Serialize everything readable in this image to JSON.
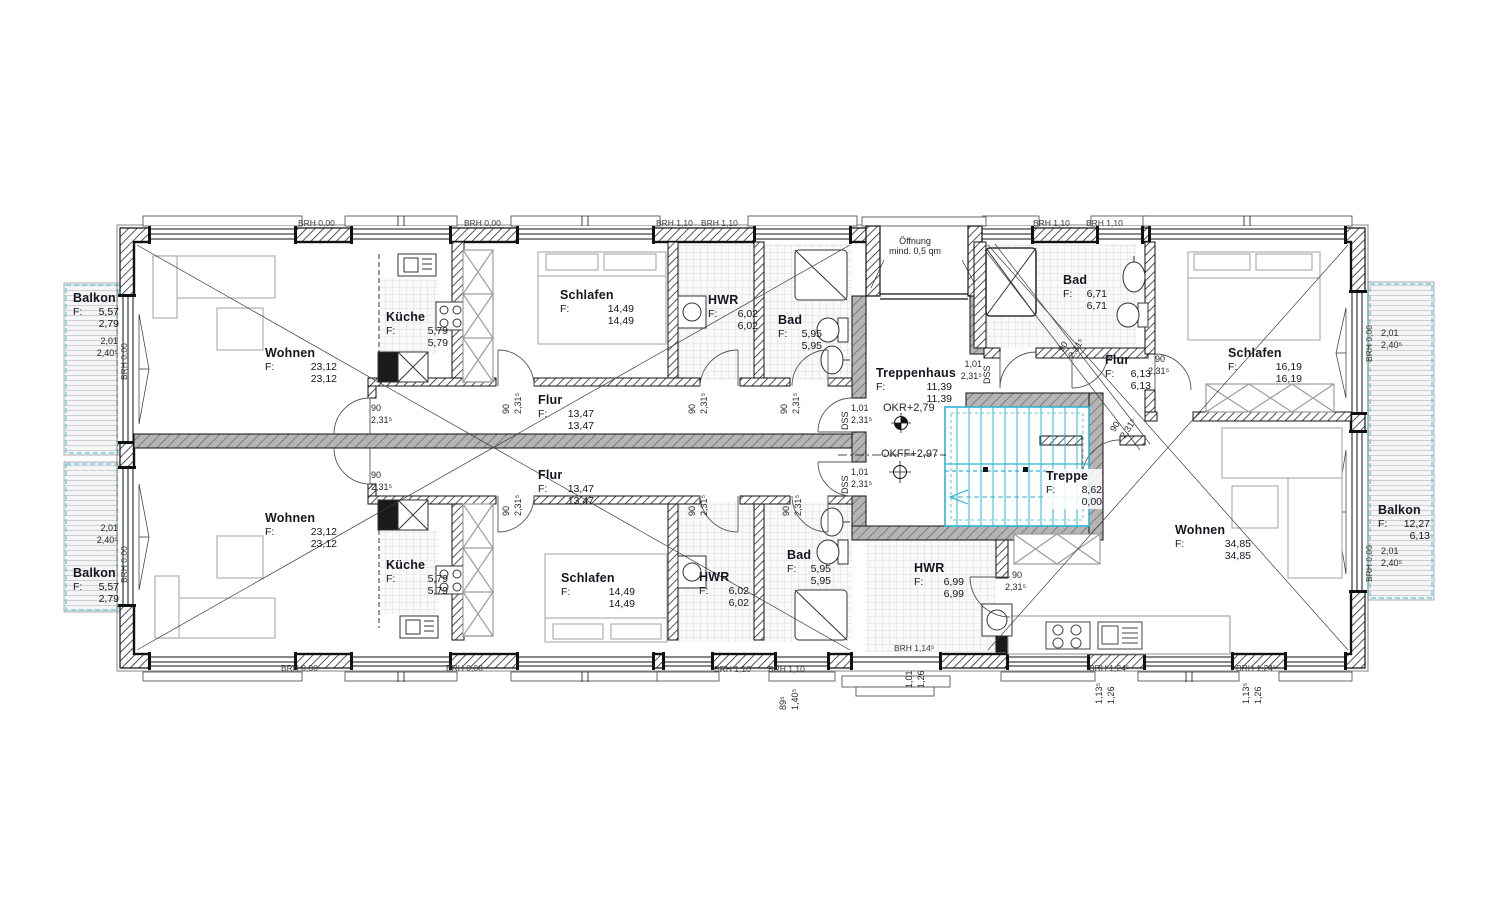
{
  "plan": {
    "type": "floor-plan",
    "language": "de",
    "f_prefix": "F:",
    "rooms": {
      "balkon_tl": {
        "name": "Balkon",
        "a1": "5,57",
        "a2": "2,79"
      },
      "balkon_bl": {
        "name": "Balkon",
        "a1": "5,57",
        "a2": "2,79"
      },
      "balkon_r": {
        "name": "Balkon",
        "a1": "12,27",
        "a2": "6,13"
      },
      "wohnen_tl": {
        "name": "Wohnen",
        "a1": "23,12",
        "a2": "23,12"
      },
      "wohnen_bl": {
        "name": "Wohnen",
        "a1": "23,12",
        "a2": "23,12"
      },
      "wohnen_r": {
        "name": "Wohnen",
        "a1": "34,85",
        "a2": "34,85"
      },
      "kueche_t": {
        "name": "Küche",
        "a1": "5,79",
        "a2": "5,79"
      },
      "kueche_b": {
        "name": "Küche",
        "a1": "5,79",
        "a2": "5,79"
      },
      "schlafen_t": {
        "name": "Schlafen",
        "a1": "14,49",
        "a2": "14,49"
      },
      "schlafen_b": {
        "name": "Schlafen",
        "a1": "14,49",
        "a2": "14,49"
      },
      "schlafen_r": {
        "name": "Schlafen",
        "a1": "16,19",
        "a2": "16,19"
      },
      "hwr_t": {
        "name": "HWR",
        "a1": "6,02",
        "a2": "6,02"
      },
      "hwr_b": {
        "name": "HWR",
        "a1": "6,02",
        "a2": "6,02"
      },
      "hwr_r": {
        "name": "HWR",
        "a1": "6,99",
        "a2": "6,99"
      },
      "bad_t": {
        "name": "Bad",
        "a1": "5,95",
        "a2": "5,95"
      },
      "bad_b": {
        "name": "Bad",
        "a1": "5,95",
        "a2": "5,95"
      },
      "bad_r": {
        "name": "Bad",
        "a1": "6,71",
        "a2": "6,71"
      },
      "flur_t": {
        "name": "Flur",
        "a1": "13,47",
        "a2": "13,47"
      },
      "flur_b": {
        "name": "Flur",
        "a1": "13,47",
        "a2": "13,47"
      },
      "flur_r": {
        "name": "Flur",
        "a1": "6,13",
        "a2": "6,13"
      },
      "treppenhaus": {
        "name": "Treppenhaus",
        "a1": "11,39",
        "a2": "11,39"
      },
      "treppe": {
        "name": "Treppe",
        "a1": "8,62",
        "a2": "0,00"
      }
    },
    "annotations": {
      "oeffnung1": "Öffnung",
      "oeffnung2": "mind. 0,5 qm",
      "okr": "OKR+2,79",
      "okff": "OKFF+2,97"
    },
    "dims": {
      "door_w": "90",
      "door_h": "2,31⁵",
      "dss": "DSS",
      "dss_w": "1,01",
      "dss_h": "2,31⁵",
      "bal_w": "2,01",
      "bal_h": "2,40⁵",
      "w101": "1,01",
      "h126": "1,26",
      "w113": "1,13⁵",
      "w89": "89⁵",
      "h140": "1,40⁵"
    },
    "brh": {
      "b000": "BRH 0,00",
      "b110": "BRH 1,10",
      "b114": "BRH 1,14⁵",
      "b124": "BRH 1,24⁵"
    },
    "colors": {
      "stair": "#2fb4d4",
      "balcony_outline": "#5fc8dd",
      "wall_gray": "#b5b5b5"
    }
  }
}
